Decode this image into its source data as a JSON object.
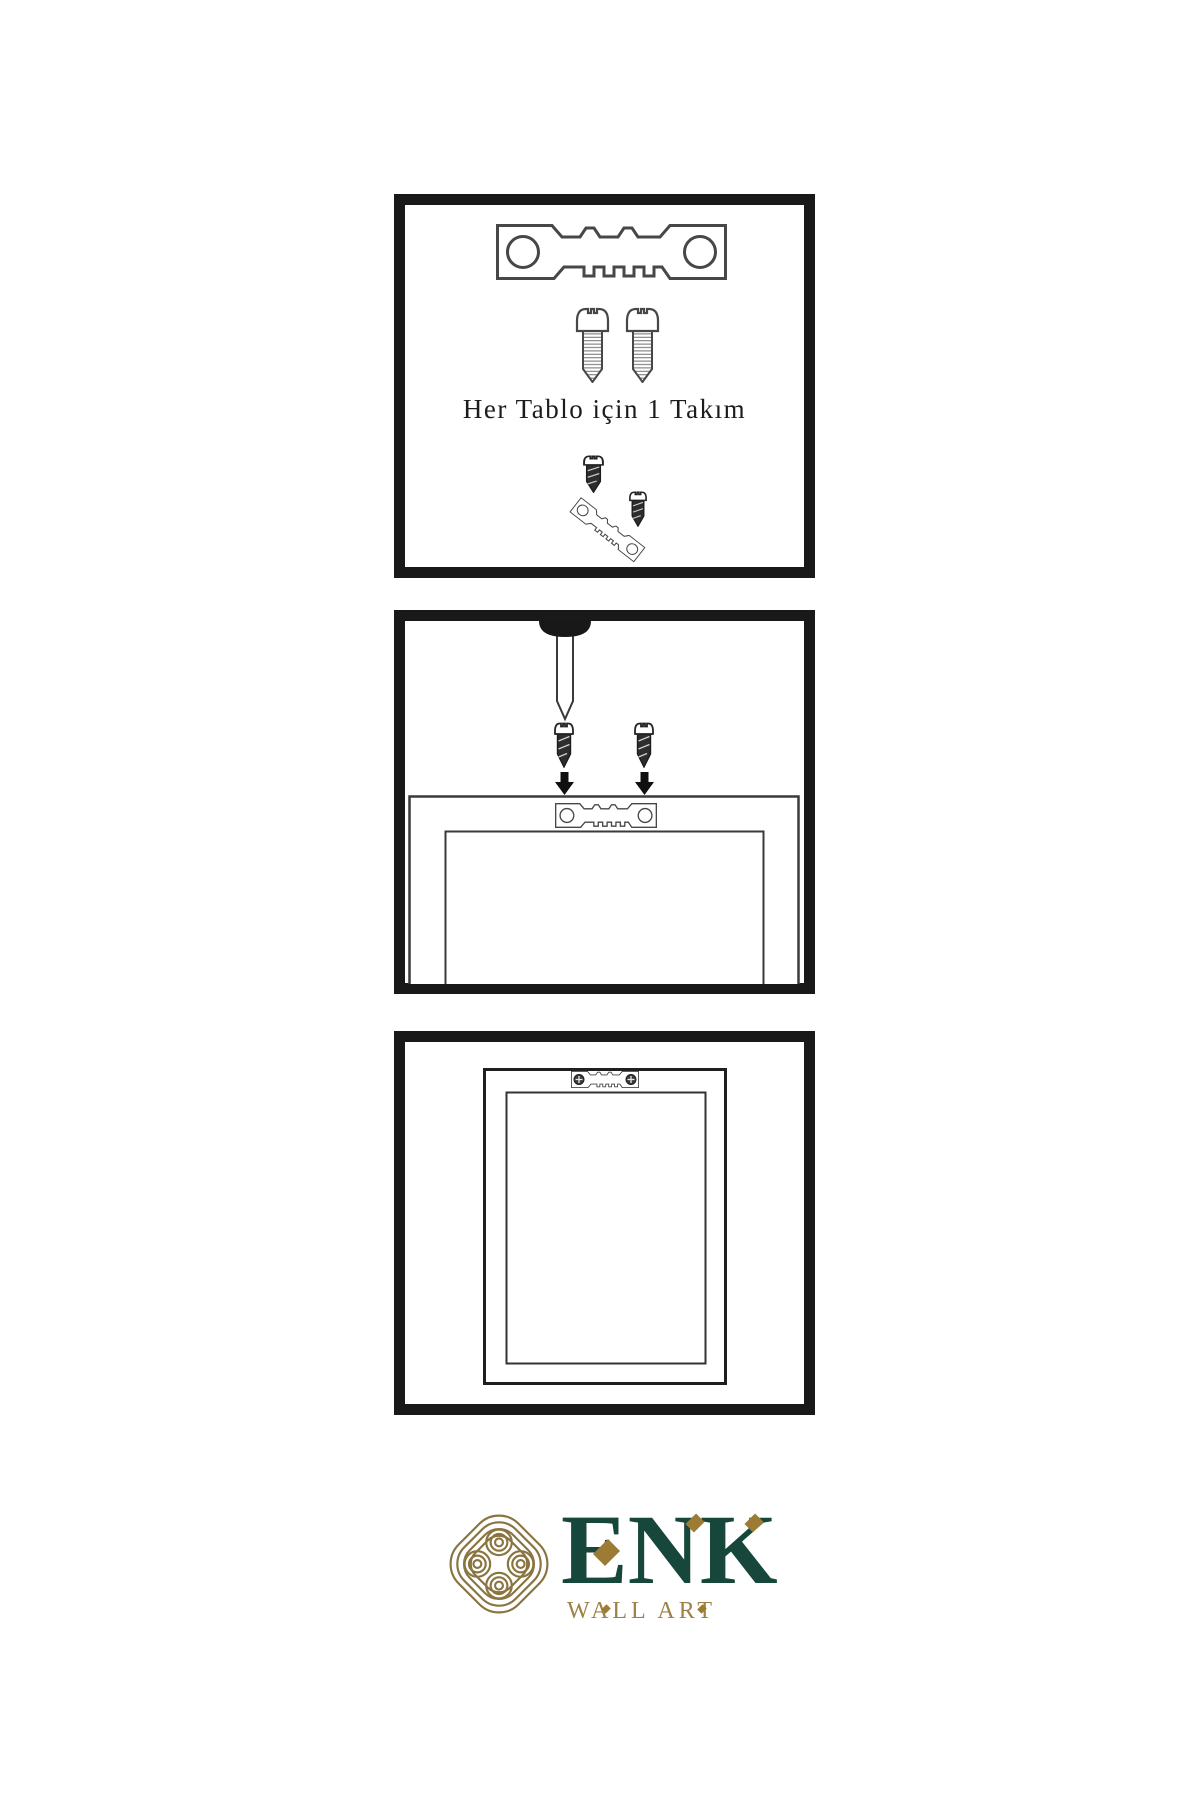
{
  "instructions": {
    "kit_caption": "Her Tablo için 1 Takım"
  },
  "panels": {
    "kit": "hardware supplied per frame",
    "install": "nail wall and screw hanger to frame back",
    "result": "frame hung on wall"
  },
  "icons": {
    "hanger": "sawtooth-hanger-icon",
    "screw": "screw-icon",
    "nail": "nail-icon",
    "arrow": "arrow-down-icon",
    "knot": "knot-logo-icon"
  },
  "brand": {
    "wordmark": "ENK",
    "tagline": "WALL ART",
    "green": "#17473a",
    "gold": "#8a7440"
  }
}
